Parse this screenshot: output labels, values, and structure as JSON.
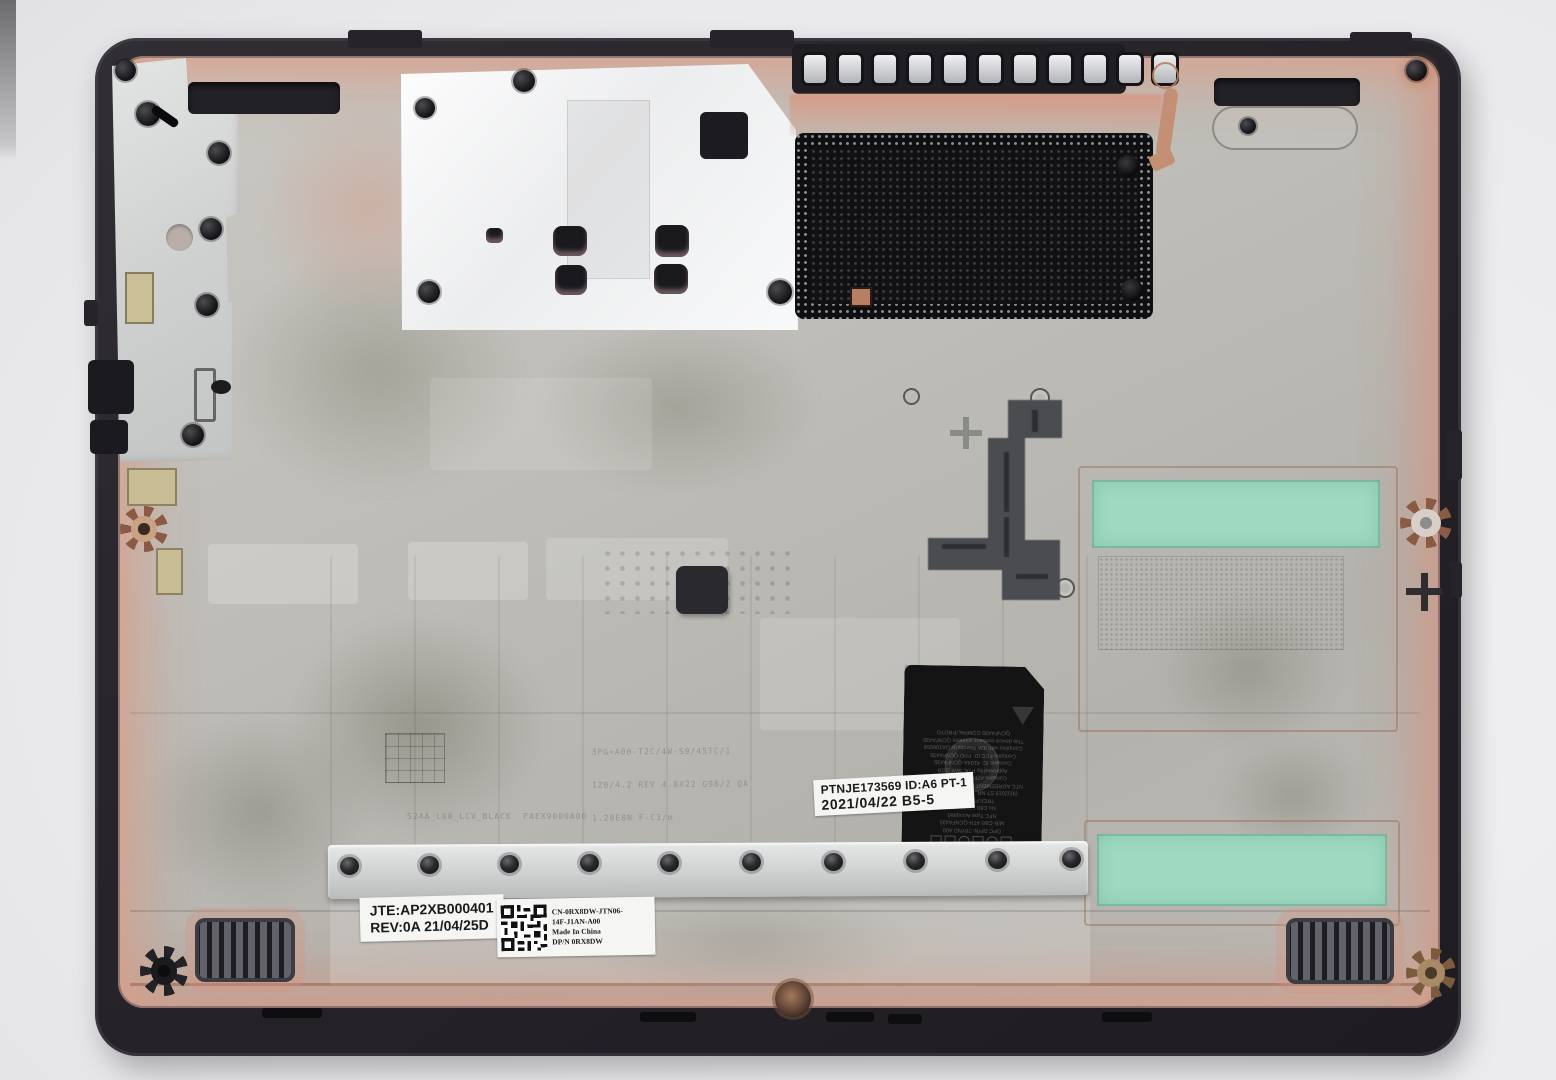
{
  "scene": {
    "subject": "laptop-bottom-base-cover-inner-side-photo",
    "background_color": "#e9e9ec"
  },
  "colors": {
    "rim_plastic": "#262429",
    "magnesium_surface": "#bfbdb8",
    "copper_tint": "#d6987e",
    "foil_shield": "#f5f6f7",
    "mesh_black": "#101013",
    "thermal_pad_green": "#9ed9c0",
    "bracket_silver": "#d7d9d9",
    "regulatory_label_black": "#141414"
  },
  "labels": {
    "manufacture": {
      "line1": "JTE:AP2XB000401",
      "line2": "REV:0A  21/04/25D"
    },
    "part_number": {
      "line1": "CN-0RX8DW-JTN06-",
      "line2": "14F-J1AN-A00",
      "line3": "Made In China",
      "line4": "DP/N  0RX8DW"
    },
    "date_code": {
      "line1": "PTNJE173569 ID:A6 PT-1",
      "line2": "2021/04/22  B5-5"
    },
    "regulatory": {
      "orientation": "rotated-180",
      "lines": [
        "DPC   DP/N: 78YND A00",
        "M/B-CBB ATH-QCNFA435",
        "NFC  Type Accepted",
        "No.C80 1216SSPC",
        "TRC/LPD2013/HZ",
        "(91)2019 ST NR. RCPQLQC19-0223",
        "NTC AGREEMENT MR 9888 ANRT 2019",
        "Contains ATFC IC: C 1A478",
        "Approved by PTA, IAW 2018",
        "Contains IC: 4104A-QCNFA435",
        "Contains FCC ID: PPD-QCNFA435",
        "Complies with IDA Standards DA106058",
        "This device contains wireless QCNFA435",
        "QCNFA435  COMPAL/PROTO"
      ]
    },
    "etched_mold": {
      "block1": [
        "3PG+A00-T2C/4W-S9/45TC/1",
        "120/4.2 REV 4.8X22 G98/2 QA",
        "1.28E0N F-C3/m",
        "UTAU #0"
      ],
      "block2": [
        "S24A_L00_LCV_BLACK  FAEX9000A00",
        "S24A_L00_LCV_B3SE   FAGX9000A00",
        "S24A_L00_LCV_GREY   FAE5900A00"
      ]
    }
  }
}
